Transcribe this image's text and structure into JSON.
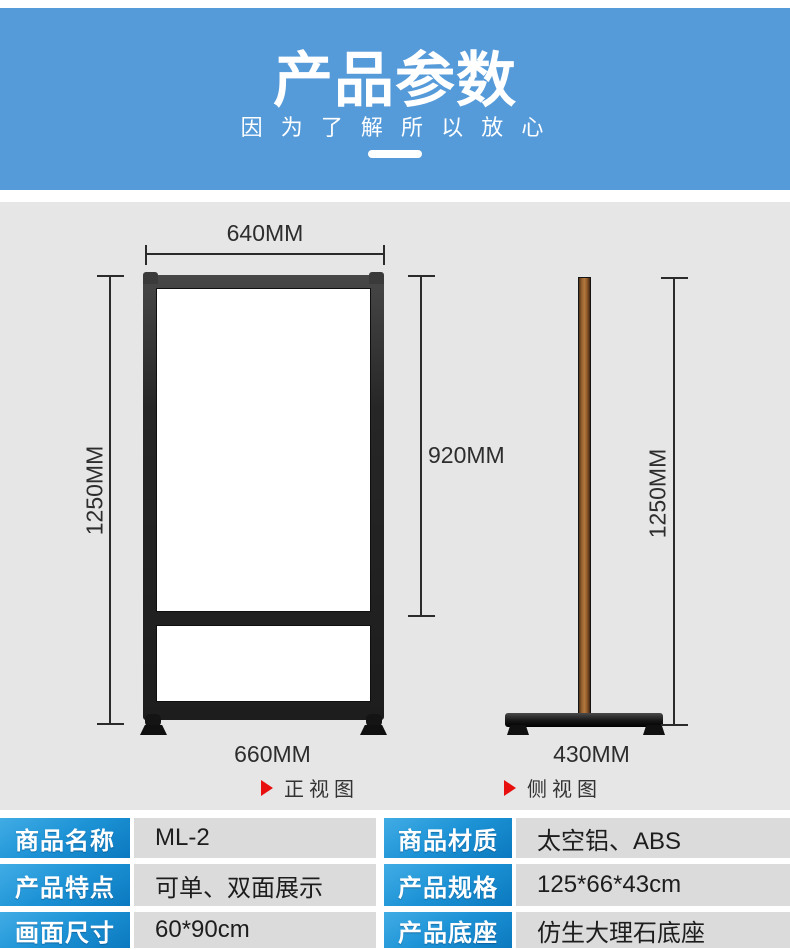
{
  "header": {
    "title": "产品参数",
    "subtitle": "因 为 了 解 所 以 放 心"
  },
  "diagram": {
    "front": {
      "top_width": "640MM",
      "height": "1250MM",
      "panel_height": "920MM",
      "base_width": "660MM",
      "caption": "正视图"
    },
    "side": {
      "height": "1250MM",
      "base_width": "430MM",
      "caption": "侧视图"
    }
  },
  "table": {
    "rows": [
      {
        "left_label": "商品名称",
        "left_value": "ML-2",
        "right_label": "商品材质",
        "right_value": "太空铝、ABS"
      },
      {
        "left_label": "产品特点",
        "left_value": "可单、双面展示",
        "right_label": "产品规格",
        "right_value": "125*66*43cm"
      },
      {
        "left_label": "画面尺寸",
        "left_value": "60*90cm",
        "right_label": "产品底座",
        "right_value": "仿生大理石底座"
      }
    ]
  },
  "colors": {
    "header_blue": "#559ad9",
    "label_blue_top": "#41ace5",
    "label_blue_bottom": "#0c79bf",
    "value_gray": "#dbdbdb",
    "diagram_gray": "#e6e6e6",
    "marker_red": "#e8100f",
    "pole_brown": "#96602f",
    "frame_black": "#1d1d1d"
  }
}
